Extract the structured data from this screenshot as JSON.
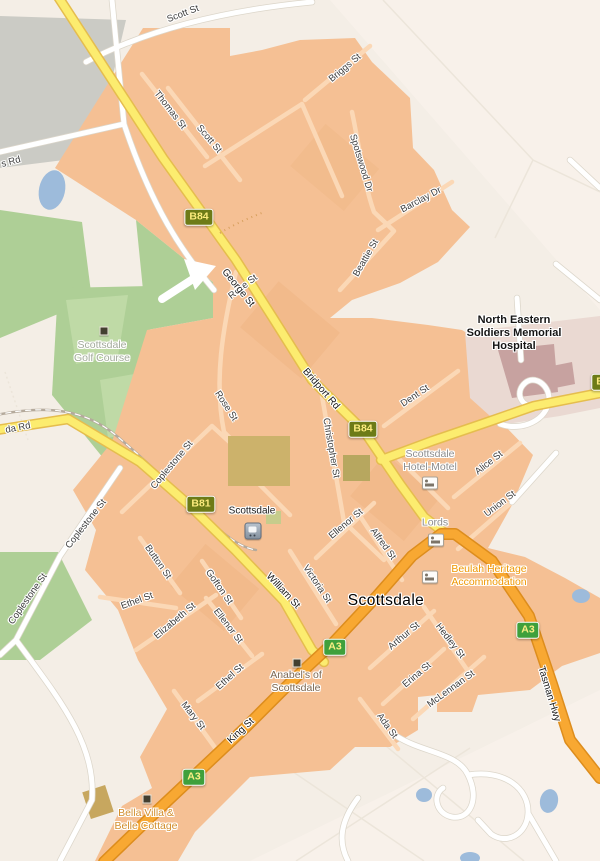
{
  "map": {
    "town": {
      "name": "Scottsdale",
      "x": 386,
      "y": 601
    },
    "station": {
      "name": "Scottsdale",
      "x": 252,
      "y": 511,
      "icon": {
        "x": 253,
        "y": 531
      }
    },
    "street_labels": [
      {
        "text": "Scott St",
        "x": 183,
        "y": 14,
        "rot": -21
      },
      {
        "text": "Thomas St",
        "x": 170,
        "y": 110,
        "rot": 52
      },
      {
        "text": "Scott St",
        "x": 209,
        "y": 139,
        "rot": 50
      },
      {
        "text": "Briggs St",
        "x": 345,
        "y": 68,
        "rot": -40
      },
      {
        "text": "Spotswood Dr",
        "x": 361,
        "y": 163,
        "rot": 73
      },
      {
        "text": "Barclay Dr",
        "x": 421,
        "y": 200,
        "rot": -28
      },
      {
        "text": "Beattie St",
        "x": 366,
        "y": 258,
        "rot": -60
      },
      {
        "text": "Rose St",
        "x": 243,
        "y": 287,
        "rot": -38
      },
      {
        "text": "Rose St",
        "x": 226,
        "y": 406,
        "rot": 57
      },
      {
        "text": "Coplestone St",
        "x": 172,
        "y": 465,
        "rot": -50
      },
      {
        "text": "Coplestone St",
        "x": 86,
        "y": 524,
        "rot": -52
      },
      {
        "text": "Coplestone St",
        "x": 28,
        "y": 599,
        "rot": -55
      },
      {
        "text": "Dent St",
        "x": 415,
        "y": 396,
        "rot": -34
      },
      {
        "text": "Christopher St",
        "x": 331,
        "y": 448,
        "rot": 80
      },
      {
        "text": "Alice St",
        "x": 489,
        "y": 463,
        "rot": -38
      },
      {
        "text": "Union St",
        "x": 500,
        "y": 504,
        "rot": -37
      },
      {
        "text": "Ellenor St",
        "x": 346,
        "y": 524,
        "rot": -40
      },
      {
        "text": "Alfred St",
        "x": 383,
        "y": 544,
        "rot": 54
      },
      {
        "text": "Victoria St",
        "x": 317,
        "y": 584,
        "rot": 56
      },
      {
        "text": "Button St",
        "x": 158,
        "y": 562,
        "rot": 55
      },
      {
        "text": "Gofton St",
        "x": 219,
        "y": 587,
        "rot": 55
      },
      {
        "text": "Ethel St",
        "x": 137,
        "y": 601,
        "rot": -20
      },
      {
        "text": "Elizabeth St",
        "x": 175,
        "y": 621,
        "rot": -40
      },
      {
        "text": "Ellenor St",
        "x": 228,
        "y": 626,
        "rot": 52
      },
      {
        "text": "Ethel St",
        "x": 230,
        "y": 677,
        "rot": -42
      },
      {
        "text": "Mary St",
        "x": 193,
        "y": 716,
        "rot": 52
      },
      {
        "text": "Arthur St",
        "x": 404,
        "y": 636,
        "rot": -40
      },
      {
        "text": "Hedley St",
        "x": 450,
        "y": 641,
        "rot": 52
      },
      {
        "text": "Erina St",
        "x": 417,
        "y": 675,
        "rot": -40
      },
      {
        "text": "McLennan St",
        "x": 451,
        "y": 689,
        "rot": -36
      },
      {
        "text": "Ada St",
        "x": 387,
        "y": 726,
        "rot": 54
      },
      {
        "text": "s Rd",
        "x": 11,
        "y": 162,
        "rot": -15
      },
      {
        "text": "da Rd",
        "x": 18,
        "y": 428,
        "rot": -11
      }
    ],
    "road_labels": [
      {
        "text": "George St",
        "x": 238,
        "y": 288,
        "rot": 51
      },
      {
        "text": "Bridport Rd",
        "x": 321,
        "y": 389,
        "rot": 49
      },
      {
        "text": "King St",
        "x": 241,
        "y": 731,
        "rot": -43
      },
      {
        "text": "William St",
        "x": 283,
        "y": 591,
        "rot": 47
      },
      {
        "text": "Tasman Hwy",
        "x": 549,
        "y": 694,
        "rot": 73
      }
    ],
    "route_shields": [
      {
        "ref": "B84",
        "kind": "B",
        "x": 199,
        "y": 217
      },
      {
        "ref": "B84",
        "kind": "B",
        "x": 363,
        "y": 429
      },
      {
        "ref": "B81",
        "kind": "B",
        "x": 201,
        "y": 504
      },
      {
        "ref": "A3",
        "kind": "A",
        "x": 335,
        "y": 647
      },
      {
        "ref": "A3",
        "kind": "A",
        "x": 528,
        "y": 630
      },
      {
        "ref": "A3",
        "kind": "A",
        "x": 194,
        "y": 777
      },
      {
        "ref": "B8",
        "kind": "B",
        "x": 603,
        "y": 382
      }
    ],
    "pois": [
      {
        "kind": "area-green",
        "x": 102,
        "y": 352,
        "lines": [
          "Scottsdale",
          "Golf Course"
        ],
        "marker": {
          "type": "square",
          "x": 104,
          "y": 331
        }
      },
      {
        "kind": "hospital",
        "x": 514,
        "y": 334,
        "lines": [
          "North Eastern",
          "Soldiers Memorial",
          "Hospital"
        ]
      },
      {
        "kind": "lodging-gray",
        "x": 430,
        "y": 461,
        "lines": [
          "Scottsdale",
          "Hotel-Motel"
        ],
        "marker": {
          "type": "bed",
          "x": 430,
          "y": 483
        }
      },
      {
        "kind": "lodging-gray",
        "x": 435,
        "y": 523,
        "lines": [
          "Lords"
        ],
        "marker": {
          "type": "bed",
          "x": 436,
          "y": 540
        }
      },
      {
        "kind": "lodging-orange",
        "x": 489,
        "y": 576,
        "lines": [
          "Beulah Heritage",
          "Accommodation"
        ],
        "marker": {
          "type": "bed",
          "x": 430,
          "y": 577
        }
      },
      {
        "kind": "business-brown",
        "x": 296,
        "y": 682,
        "lines": [
          "Anabel's of",
          "Scottsdale"
        ],
        "marker": {
          "type": "square",
          "x": 297,
          "y": 663
        }
      },
      {
        "kind": "lodging-orange2",
        "x": 146,
        "y": 820,
        "lines": [
          "Bella Villa &",
          "Belle Cottage"
        ],
        "marker": {
          "type": "square",
          "x": 147,
          "y": 799
        }
      }
    ],
    "colors": {
      "cream": "#f4eee6",
      "creamPink": "#f8f1ea",
      "region": "#f5c094",
      "street": "#fbd8b6",
      "yellowFill": "#fcec6f",
      "yellowCase": "#e5bd4e",
      "orangeFill": "#f8a832",
      "orangeCase": "#dd8d1d",
      "whiteCase": "#dcd6ca",
      "green": "#aecf96",
      "greenLight": "#bfdaa6",
      "gray": "#cbcbc5",
      "water": "#9dbbdb",
      "rail": "#b5aa9c",
      "hospGround": "#ead9d2",
      "hospBldg": "#c7a2a0",
      "shieldB": "#6d7b17",
      "shieldBText": "#fceb7d",
      "shieldA": "#3fa03c",
      "shieldAText": "#fcef85"
    }
  }
}
